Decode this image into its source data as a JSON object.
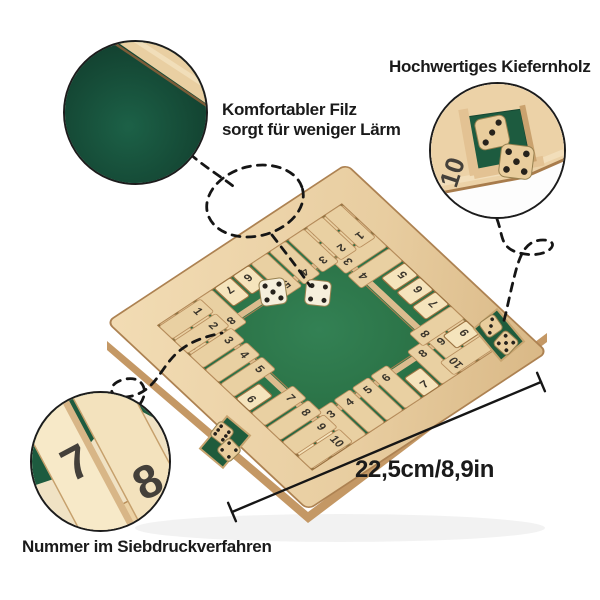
{
  "annotations": {
    "material": "Hochwertiges Kiefernholz",
    "felt": "Komfortabler Filz\nsorgt für weniger Lärm",
    "numbers": "Nummer im Siebdruckverfahren",
    "dimension": "22,5cm/8,9in"
  },
  "callouts": {
    "felt": {
      "shows": "green-felt-with-wood-edge"
    },
    "dice_corner": {
      "tile_number": "10",
      "dice": [
        3,
        5
      ]
    },
    "tiles": {
      "numbers": [
        "7",
        "8"
      ]
    }
  },
  "board": {
    "center_dice": [
      5,
      4
    ],
    "corner_dice_sw": [
      6,
      4
    ],
    "corner_dice_se": [
      3,
      5
    ],
    "sides": {
      "south": [
        {
          "n": 1,
          "state": "up"
        },
        {
          "n": 2,
          "state": "up"
        },
        {
          "n": 3,
          "state": "down"
        },
        {
          "n": 4,
          "state": "down"
        },
        {
          "n": 5,
          "state": "down"
        },
        {
          "n": 6,
          "state": "down"
        },
        {
          "n": 7,
          "state": "up"
        },
        {
          "n": 8,
          "state": "down"
        },
        {
          "n": 9,
          "state": "down"
        },
        {
          "n": 10,
          "state": "down"
        }
      ],
      "east": [
        {
          "n": 10,
          "state": "down"
        },
        {
          "n": 9,
          "state": "up"
        },
        {
          "n": 8,
          "state": "down"
        },
        {
          "n": 7,
          "state": "up"
        },
        {
          "n": 6,
          "state": "up"
        },
        {
          "n": 5,
          "state": "up"
        },
        {
          "n": 4,
          "state": "down"
        },
        {
          "n": 3,
          "state": "down"
        },
        {
          "n": 2,
          "state": "down"
        },
        {
          "n": 1,
          "state": "down"
        }
      ],
      "north": [
        {
          "n": 1,
          "state": "down"
        },
        {
          "n": 2,
          "state": "down"
        },
        {
          "n": 3,
          "state": "down"
        },
        {
          "n": 4,
          "state": "down"
        },
        {
          "n": 5,
          "state": "down"
        },
        {
          "n": 6,
          "state": "up"
        },
        {
          "n": 7,
          "state": "up"
        },
        {
          "n": 8,
          "state": "down"
        },
        {
          "n": 9,
          "state": "down"
        },
        {
          "n": 10,
          "state": "down"
        }
      ],
      "west": [
        {
          "n": 1,
          "state": "down"
        },
        {
          "n": 2,
          "state": "down"
        },
        {
          "n": 3,
          "state": "down"
        },
        {
          "n": 4,
          "state": "down"
        },
        {
          "n": 5,
          "state": "down"
        },
        {
          "n": 6,
          "state": "up"
        },
        {
          "n": 7,
          "state": "down"
        },
        {
          "n": 8,
          "state": "down"
        },
        {
          "n": 9,
          "state": "down"
        },
        {
          "n": 10,
          "state": "down"
        }
      ]
    }
  },
  "colors": {
    "felt": "#2e7b4d",
    "felt_dark": "#1a5c42",
    "wood_light": "#f0d9b0",
    "wood_shadow": "#c49a66",
    "text": "#1a1a1a"
  }
}
